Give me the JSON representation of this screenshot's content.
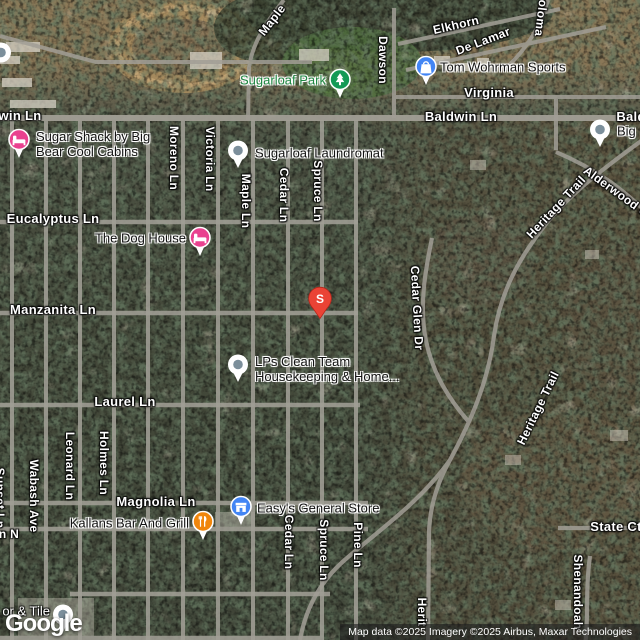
{
  "map": {
    "marker": {
      "label": "S"
    },
    "logo": "Google",
    "attribution": "Map data ©2025 Imagery ©2025 Airbus, Maxar Technologies"
  },
  "colors": {
    "marker_red": "#EA4335",
    "park_green": "#149a55",
    "park_text_green": "#1d8640",
    "lodging_pink": "#E9418F",
    "store_blue": "#4285F4",
    "restaurant_orange": "#F0860C",
    "pin_gray": "#7C8F9B",
    "road_gray": "#A19E95"
  },
  "streets": [
    {
      "label": "Maple"
    },
    {
      "label": "Elkhorn"
    },
    {
      "label": "De Lamar"
    },
    {
      "label": "Dawson"
    },
    {
      "label": "oloma"
    },
    {
      "label": "Virginia"
    },
    {
      "label": "Baldwin Ln"
    },
    {
      "label": "win Ln"
    },
    {
      "label": "Bald"
    },
    {
      "label": "Moreno Ln"
    },
    {
      "label": "Victoria Ln"
    },
    {
      "label": "Maple Ln"
    },
    {
      "label": "Cedar Ln"
    },
    {
      "label": "Spruce Ln"
    },
    {
      "label": "Eucalyptus Ln"
    },
    {
      "label": "Manzanita Ln"
    },
    {
      "label": "Cedar Glen Dr"
    },
    {
      "label": "Heritage Trail"
    },
    {
      "label": "Alderwood Ct"
    },
    {
      "label": "Laurel Ln"
    },
    {
      "label": "Heritage Trail"
    },
    {
      "label": "Magnolia Ln"
    },
    {
      "label": "Leonard Ln"
    },
    {
      "label": "Holmes Ln"
    },
    {
      "label": "Wabash Ave"
    },
    {
      "label": "Sunset Ln"
    },
    {
      "label": "n N"
    },
    {
      "label": "Cedar Ln"
    },
    {
      "label": "Spruce Ln"
    },
    {
      "label": "Pine Ln"
    },
    {
      "label": "State Ct"
    },
    {
      "label": "Shenandoah"
    },
    {
      "label": "Herit"
    }
  ],
  "pois": [
    {
      "name": "Sugarloaf Park",
      "lines": [
        "Sugarloaf Park"
      ]
    },
    {
      "name": "Tom Wohrman Sports",
      "lines": [
        "Tom Wohrman Sports"
      ]
    },
    {
      "name": "Sugar Shack by Big Bear Cool Cabins",
      "lines": [
        "Sugar Shack by Big",
        "Bear Cool Cabins"
      ]
    },
    {
      "name": "Sugarloaf Laundromat",
      "lines": [
        "Sugarloaf Laundromat"
      ]
    },
    {
      "name": "The Dog House",
      "lines": [
        "The Dog House"
      ]
    },
    {
      "name": "LPs Clean Team Housekeeping & Home",
      "lines": [
        "LPs Clean Team",
        "Housekeeping & Home..."
      ]
    },
    {
      "name": "Easy's General Store",
      "lines": [
        "Easy's General Store"
      ]
    },
    {
      "name": "Kallans Bar And Grill",
      "lines": [
        "Kallans Bar And Grill"
      ]
    },
    {
      "name": "Big",
      "lines": [
        "Big"
      ]
    },
    {
      "name": "or & Tile",
      "lines": [
        "or & Tile"
      ]
    }
  ]
}
